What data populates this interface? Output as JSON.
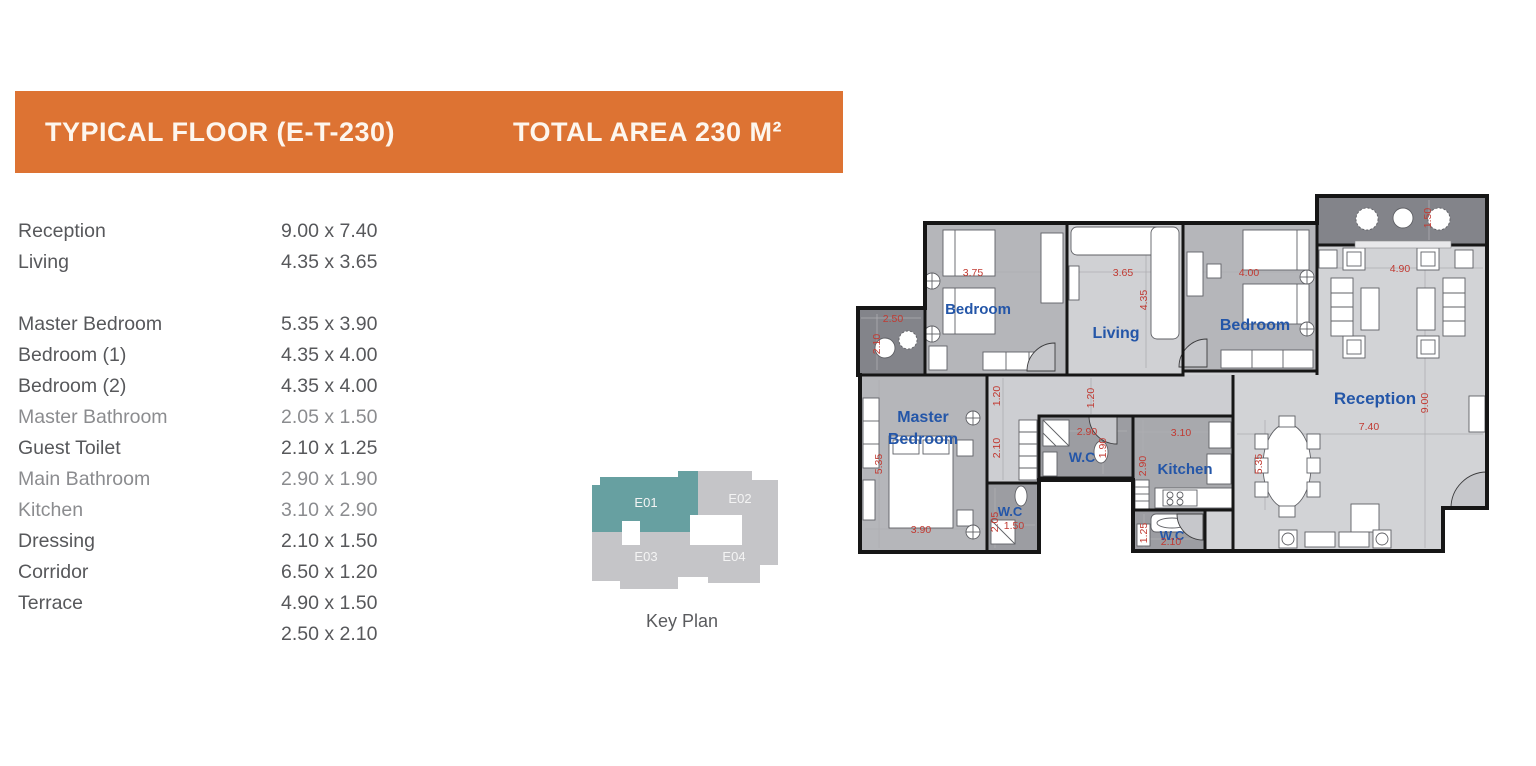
{
  "header": {
    "title": "TYPICAL FLOOR (E-T-230)",
    "total_area": "TOTAL AREA 230 M²"
  },
  "room_list": [
    {
      "label": "Reception",
      "dims": "9.00 x 7.40"
    },
    {
      "label": "Living",
      "dims": "4.35 x 3.65"
    },
    {
      "label": "Master Bedroom",
      "dims": "5.35 x 3.90"
    },
    {
      "label": "Bedroom (1)",
      "dims": "4.35 x 4.00"
    },
    {
      "label": "Bedroom (2)",
      "dims": "4.35 x 4.00"
    },
    {
      "label": "Master Bathroom",
      "dims": "2.05 x 1.50"
    },
    {
      "label": "Guest Toilet",
      "dims": "2.10 x 1.25"
    },
    {
      "label": "Main Bathroom",
      "dims": "2.90 x 1.90"
    },
    {
      "label": "Kitchen",
      "dims": "3.10 x 2.90"
    },
    {
      "label": "Dressing",
      "dims": "2.10 x 1.50"
    },
    {
      "label": "Corridor",
      "dims": "6.50 x 1.20"
    },
    {
      "label": "Terrace",
      "dims": "4.90 x 1.50"
    },
    {
      "label": "",
      "dims": "2.50 x 2.10"
    }
  ],
  "key_plan": {
    "caption": "Key Plan",
    "units": [
      {
        "id": "E01",
        "highlighted": true
      },
      {
        "id": "E02",
        "highlighted": false
      },
      {
        "id": "E03",
        "highlighted": false
      },
      {
        "id": "E04",
        "highlighted": false
      }
    ]
  },
  "fp": {
    "room_bedroom": "Bedroom",
    "room_living": "Living",
    "room_reception": "Reception",
    "room_master_line1": "Master",
    "room_master_line2": "Bedroom",
    "room_wc": "W.C",
    "room_kitchen": "Kitchen",
    "dim_3_75": "3.75",
    "dim_3_65": "3.65",
    "dim_4_35": "4.35",
    "dim_4_00": "4.00",
    "dim_4_90": "4.90",
    "dim_1_50": "1.50",
    "dim_2_50": "2.50",
    "dim_2_10": "2.10",
    "dim_1_20": "1.20",
    "dim_5_35": "5.35",
    "dim_3_90": "3.90",
    "dim_2_90": "2.90",
    "dim_1_90": "1.90",
    "dim_3_10": "3.10",
    "dim_2_05": "2.05",
    "dim_1_25": "1.25",
    "dim_9_00": "9.00",
    "dim_7_40": "7.40"
  },
  "colors": {
    "accent_orange": "#dd7333",
    "keyplan_highlight": "#67a0a1",
    "keyplan_base": "#c5c5c8",
    "room_label_blue": "#2456a8",
    "dimension_red": "#c13a32"
  }
}
